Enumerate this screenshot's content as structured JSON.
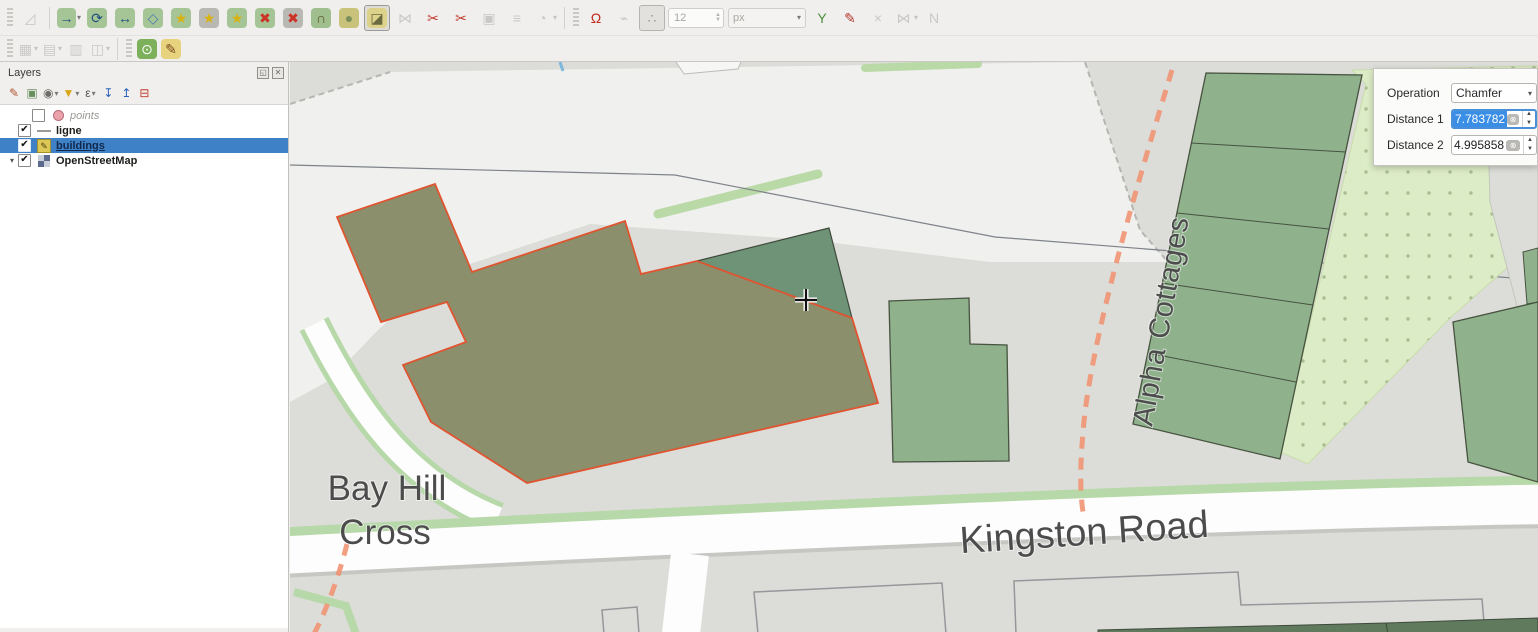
{
  "colors": {
    "selection_blue": "#3f81c6",
    "spin_selection": "#3a8ee6",
    "edited_outline": "#e05430",
    "building_olive": "#8b8f6b",
    "building_green": "#8fb28c",
    "building_dark_green": "#6e9376",
    "orchard": "#dcecc6",
    "road_white": "#fdfdfd",
    "road_verge": "#b7d8a8",
    "path_orange": "#ef9473"
  },
  "toolbar_row1": [
    {
      "type": "grip"
    },
    {
      "type": "btn",
      "name": "enable-advanced-digitizing",
      "glyph": "◿",
      "fg": "#7e7e7a",
      "state": "disabled"
    },
    {
      "type": "sep"
    },
    {
      "type": "btn",
      "name": "move-feature",
      "glyph": "→",
      "bg": "#a6c596",
      "fg": "#1f4f7e",
      "caret": true
    },
    {
      "type": "btn",
      "name": "rotate-feature",
      "glyph": "⟳",
      "bg": "#a6c596",
      "fg": "#1f4f7e"
    },
    {
      "type": "btn",
      "name": "scale-feature",
      "glyph": "↔",
      "bg": "#a6c596",
      "fg": "#1f4f7e"
    },
    {
      "type": "btn",
      "name": "simplify-feature",
      "glyph": "◇",
      "bg": "#a6c596",
      "fg": "#4a7ab0"
    },
    {
      "type": "btn",
      "name": "add-ring",
      "glyph": "★",
      "bg": "#a6c596",
      "fg": "#d8b312"
    },
    {
      "type": "btn",
      "name": "add-part",
      "glyph": "★",
      "bg": "#b9b9b3",
      "fg": "#d8b312"
    },
    {
      "type": "btn",
      "name": "fill-ring",
      "glyph": "★",
      "bg": "#a6c596",
      "fg": "#d8b312"
    },
    {
      "type": "btn",
      "name": "delete-ring",
      "glyph": "✖",
      "bg": "#a6c596",
      "fg": "#cc3327"
    },
    {
      "type": "btn",
      "name": "delete-part",
      "glyph": "✖",
      "bg": "#b9b9b3",
      "fg": "#cc3327"
    },
    {
      "type": "btn",
      "name": "offset-curve",
      "glyph": "∩",
      "bg": "#9fbf8f",
      "fg": "#5a5320"
    },
    {
      "type": "btn",
      "name": "reshape-features",
      "glyph": "●",
      "bg": "#c9c27a",
      "fg": "#7a8f5a"
    },
    {
      "type": "btn",
      "name": "fillet-chamfer-tool",
      "glyph": "◪",
      "bg": "#ddd28a",
      "fg": "#6a6a40",
      "state": "active"
    },
    {
      "type": "btn",
      "name": "vertex-tool",
      "glyph": "⋈",
      "fg": "#8a8a86",
      "state": "disabled"
    },
    {
      "type": "btn",
      "name": "split-features",
      "glyph": "✂",
      "fg": "#c23b2e"
    },
    {
      "type": "btn",
      "name": "split-parts",
      "glyph": "✂",
      "fg": "#c23b2e"
    },
    {
      "type": "btn",
      "name": "merge-features",
      "glyph": "▣",
      "fg": "#8a8a86",
      "state": "disabled"
    },
    {
      "type": "btn",
      "name": "merge-attributes",
      "glyph": "≡",
      "fg": "#8a8a86",
      "state": "disabled"
    },
    {
      "type": "btn",
      "name": "rotate-point-symbols",
      "glyph": "◔",
      "fg": "#8a8a86",
      "state": "disabled",
      "caret": true
    },
    {
      "type": "sep"
    },
    {
      "type": "grip"
    },
    {
      "type": "btn",
      "name": "enable-snapping",
      "glyph": "Ω",
      "fg": "#c1271d"
    },
    {
      "type": "btn",
      "name": "self-snapping",
      "glyph": "⌁",
      "fg": "#8a8a86",
      "state": "disabled"
    },
    {
      "type": "btn",
      "name": "snapping-on-intersection",
      "glyph": "∴",
      "fg": "#9a9a96",
      "state": "pressed"
    },
    {
      "type": "input",
      "name": "snapping-tolerance-input",
      "value": "12"
    },
    {
      "type": "combo",
      "name": "snapping-units-combo",
      "value": "px"
    },
    {
      "type": "btn",
      "name": "enable-tracing",
      "glyph": "Y",
      "fg": "#4e8f3c"
    },
    {
      "type": "btn",
      "name": "avoid-overlap",
      "glyph": "✎",
      "fg": "#b03a2e"
    },
    {
      "type": "btn",
      "name": "remove-unused-vertices",
      "glyph": "×",
      "fg": "#8a8a86",
      "state": "disabled"
    },
    {
      "type": "btn",
      "name": "topological-editing",
      "glyph": "⋈",
      "fg": "#8a8a86",
      "state": "disabled",
      "caret": true
    },
    {
      "type": "btn",
      "name": "snapping-to-grid",
      "glyph": "N",
      "fg": "#8a8a86",
      "state": "disabled"
    }
  ],
  "toolbar_row2": [
    {
      "type": "grip"
    },
    {
      "type": "btn",
      "name": "raster-tools",
      "glyph": "▦",
      "fg": "#8a8a86",
      "state": "disabled",
      "caret": true
    },
    {
      "type": "btn",
      "name": "table-tools",
      "glyph": "▤",
      "fg": "#8a8a86",
      "state": "disabled",
      "caret": true
    },
    {
      "type": "btn",
      "name": "geometry-checker",
      "glyph": "▥",
      "fg": "#8a8a86",
      "state": "disabled"
    },
    {
      "type": "btn",
      "name": "diagram-tools",
      "glyph": "◫",
      "fg": "#8a8a86",
      "state": "disabled",
      "caret": true
    },
    {
      "type": "sep"
    },
    {
      "type": "grip"
    },
    {
      "type": "btn",
      "name": "osm-place-search",
      "glyph": "⊙",
      "bg": "#7db05b",
      "fg": "#ffffff"
    },
    {
      "type": "btn",
      "name": "edit-osm-map",
      "glyph": "✎",
      "bg": "#e7d27d",
      "fg": "#7a4a22"
    }
  ],
  "layers_panel": {
    "title": "Layers",
    "window_icons": [
      {
        "name": "float-panel-icon",
        "glyph": "◱"
      },
      {
        "name": "close-panel-icon",
        "glyph": "✕"
      }
    ],
    "tools": [
      {
        "name": "open-layer-styling-icon",
        "glyph": "✎",
        "fg": "#b3552e"
      },
      {
        "name": "add-group-icon",
        "glyph": "▣",
        "fg": "#6a8f5f"
      },
      {
        "name": "manage-map-themes-icon",
        "glyph": "◉",
        "fg": "#6e6d69",
        "caret": true
      },
      {
        "name": "filter-legend-icon",
        "glyph": "▼",
        "fg": "#d9a516",
        "caret": true
      },
      {
        "name": "filter-by-expression-icon",
        "glyph": "ε",
        "fg": "#55544f",
        "caret": true
      },
      {
        "name": "expand-all-icon",
        "glyph": "↧",
        "fg": "#2a62b8"
      },
      {
        "name": "collapse-all-icon",
        "glyph": "↥",
        "fg": "#2a62b8"
      },
      {
        "name": "remove-layer-icon",
        "glyph": "⊟",
        "fg": "#c0392b"
      }
    ],
    "layers": [
      {
        "label": "points",
        "checked": false,
        "marker": "point",
        "italic": true,
        "indent": true
      },
      {
        "label": "ligne",
        "checked": true,
        "marker": "line",
        "bold": true
      },
      {
        "label": "buildings",
        "checked": true,
        "marker": "edit",
        "bold": true,
        "selected": true
      },
      {
        "label": "OpenStreetMap",
        "checked": true,
        "marker": "osm",
        "bold": true,
        "expandable": true
      }
    ],
    "checkmark": "✔",
    "expander_glyph": "▾"
  },
  "map": {
    "labels": {
      "bay_hill_line1": "Bay Hill",
      "bay_hill_line2": "Cross",
      "kingston_road": "Kingston Road",
      "alpha_cottages": "Alpha Cottages"
    }
  },
  "operation_panel": {
    "operation_label": "Operation",
    "operation_value": "Chamfer",
    "distance1_label": "Distance 1",
    "distance1_value": "7.783782",
    "distance2_label": "Distance 2",
    "distance2_value": "4.995858",
    "clear_icon_glyph": "⊗",
    "caret_glyph": "▾",
    "spin_up_glyph": "▲",
    "spin_down_glyph": "▼"
  }
}
